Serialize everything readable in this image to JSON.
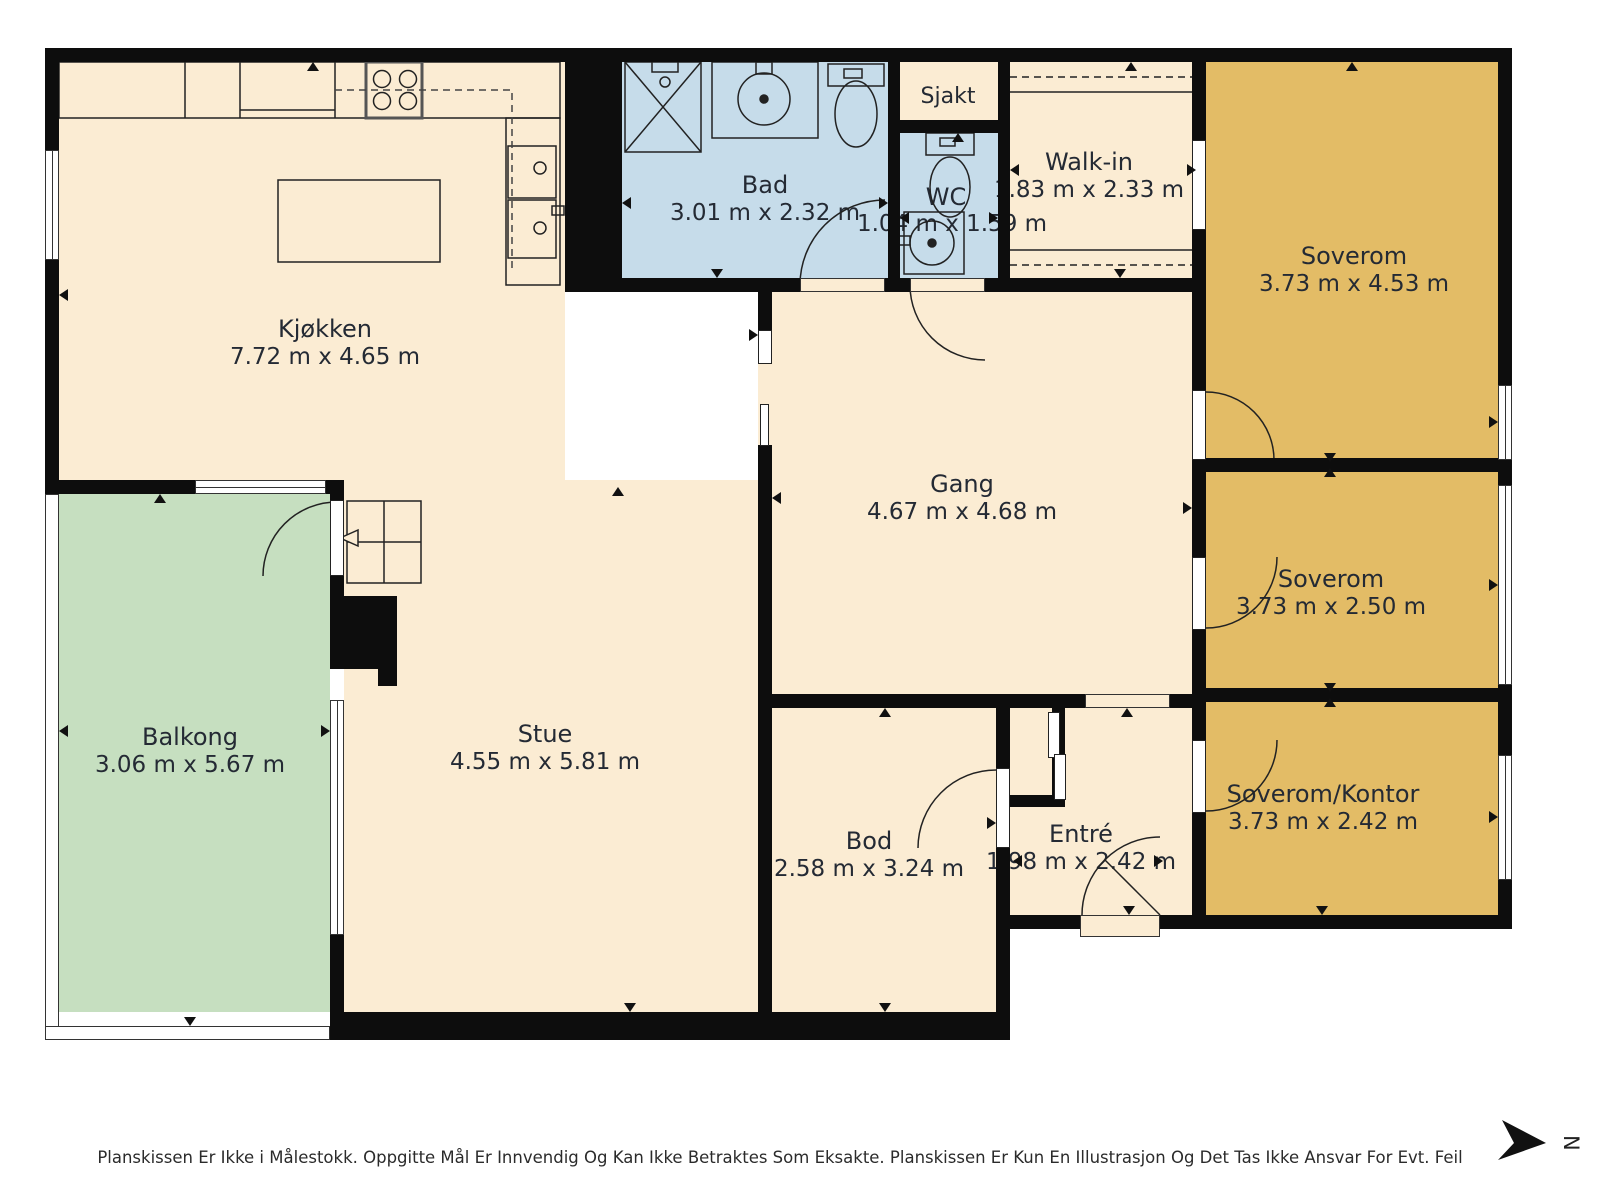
{
  "rooms": [
    {
      "id": "kjokken",
      "name": "Kjøkken",
      "dims": "7.72 m x 4.65 m"
    },
    {
      "id": "bad",
      "name": "Bad",
      "dims": "3.01 m x 2.32 m"
    },
    {
      "id": "wc",
      "name": "WC",
      "dims": "1.04 m x 1.59 m"
    },
    {
      "id": "sjakt",
      "name": "Sjakt",
      "dims": ""
    },
    {
      "id": "walkin",
      "name": "Walk-in",
      "dims": "1.83 m x 2.33 m"
    },
    {
      "id": "soverom1",
      "name": "Soverom",
      "dims": "3.73 m x 4.53 m"
    },
    {
      "id": "gang",
      "name": "Gang",
      "dims": "4.67 m x 4.68 m"
    },
    {
      "id": "soverom2",
      "name": "Soverom",
      "dims": "3.73 m x 2.50 m"
    },
    {
      "id": "soverom_kontor",
      "name": "Soverom/Kontor",
      "dims": "3.73 m x 2.42 m"
    },
    {
      "id": "stue",
      "name": "Stue",
      "dims": "4.55 m x 5.81 m"
    },
    {
      "id": "balkong",
      "name": "Balkong",
      "dims": "3.06 m x 5.67 m"
    },
    {
      "id": "bod",
      "name": "Bod",
      "dims": "2.58 m x 3.24 m"
    },
    {
      "id": "entre",
      "name": "Entré",
      "dims": "1.98 m x 2.42 m"
    }
  ],
  "compass": {
    "label": "N"
  },
  "disclaimer": "Planskissen Er Ikke i Målestokk. Oppgitte Mål Er Innvendig Og Kan Ikke Betraktes Som Eksakte. Planskissen Er Kun En Illustrasjon Og Det Tas Ikke Ansvar For Evt. Feil",
  "colors": {
    "floor": "#fbecd3",
    "wet_room": "#c6dcea",
    "bedroom": "#e3bc66",
    "balcony": "#c6dfc0",
    "wall": "#0d0d0d",
    "text": "#242a34"
  },
  "markers": [
    {
      "d": "up",
      "x": 313,
      "y": 62
    },
    {
      "d": "left",
      "x": 59,
      "y": 295
    },
    {
      "d": "down",
      "x": 717,
      "y": 278
    },
    {
      "d": "left",
      "x": 622,
      "y": 203
    },
    {
      "d": "right",
      "x": 888,
      "y": 203
    },
    {
      "d": "up",
      "x": 958,
      "y": 133
    },
    {
      "d": "left",
      "x": 900,
      "y": 218
    },
    {
      "d": "right",
      "x": 998,
      "y": 218
    },
    {
      "d": "up",
      "x": 1131,
      "y": 62
    },
    {
      "d": "down",
      "x": 1120,
      "y": 278
    },
    {
      "d": "left",
      "x": 1010,
      "y": 170
    },
    {
      "d": "right",
      "x": 1196,
      "y": 170
    },
    {
      "d": "up",
      "x": 1352,
      "y": 62
    },
    {
      "d": "right",
      "x": 1498,
      "y": 422
    },
    {
      "d": "right",
      "x": 1498,
      "y": 585
    },
    {
      "d": "right",
      "x": 1498,
      "y": 817
    },
    {
      "d": "down",
      "x": 1330,
      "y": 462
    },
    {
      "d": "up",
      "x": 1330,
      "y": 468
    },
    {
      "d": "down",
      "x": 1330,
      "y": 692
    },
    {
      "d": "up",
      "x": 1330,
      "y": 698
    },
    {
      "d": "right",
      "x": 1192,
      "y": 508
    },
    {
      "d": "right",
      "x": 758,
      "y": 335
    },
    {
      "d": "left",
      "x": 772,
      "y": 498
    },
    {
      "d": "up",
      "x": 618,
      "y": 487
    },
    {
      "d": "up",
      "x": 160,
      "y": 494
    },
    {
      "d": "left",
      "x": 59,
      "y": 731
    },
    {
      "d": "right",
      "x": 330,
      "y": 731
    },
    {
      "d": "down",
      "x": 190,
      "y": 1026
    },
    {
      "d": "down",
      "x": 630,
      "y": 1012
    },
    {
      "d": "down",
      "x": 885,
      "y": 1012
    },
    {
      "d": "up",
      "x": 885,
      "y": 708
    },
    {
      "d": "right",
      "x": 996,
      "y": 823
    },
    {
      "d": "up",
      "x": 1127,
      "y": 708
    },
    {
      "d": "down",
      "x": 1129,
      "y": 915
    },
    {
      "d": "down",
      "x": 1322,
      "y": 915
    },
    {
      "d": "left",
      "x": 1013,
      "y": 861
    },
    {
      "d": "right",
      "x": 1163,
      "y": 861
    }
  ]
}
